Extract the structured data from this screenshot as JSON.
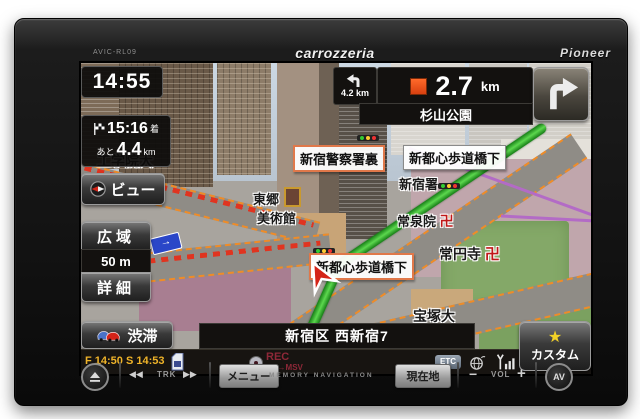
{
  "device": {
    "model": "AVIC-RL09",
    "brand": "carrozzeria",
    "maker": "Pioneer"
  },
  "clock": {
    "time": "14:55"
  },
  "eta": {
    "time": "15:16",
    "suffix": "着",
    "prefix": "あと",
    "value": "4.4",
    "unit": "km"
  },
  "sidebar": {
    "view": "ビュー",
    "wide": "広域",
    "scale": "50 m",
    "detail": "詳細"
  },
  "guidance": {
    "sub_distance": "4.2 km",
    "distance": "2.7",
    "unit": "km",
    "waypoint": "杉山公園"
  },
  "map": {
    "kogakuin": "工学院大",
    "police_rear": "新宿警察署裏",
    "bridge": "新都心歩道橋下",
    "togo": "東郷",
    "museum": "美術館",
    "shinjuku_police": "新宿署",
    "josenin": "常泉院",
    "joenji": "常円寺",
    "takarazuka": "宝塚大",
    "manji": "卍",
    "oneway_arrow": "→"
  },
  "status": {
    "traffic": "渋滞",
    "vics": "F 14:50 S 14:53",
    "address": "新宿区 西新宿7",
    "custom": "カスタム",
    "star": "★",
    "rec": "REC",
    "rec_sub": "CD→MSV",
    "etc": "ETC"
  },
  "hardware": {
    "prev": "◀◀",
    "trk": "TRK",
    "next": "▶▶",
    "menu": "メニュー",
    "memory": "MEMORY NAVIGATION",
    "location": "現在地",
    "minus": "−",
    "vol": "VOL",
    "plus": "+",
    "av": "AV"
  }
}
